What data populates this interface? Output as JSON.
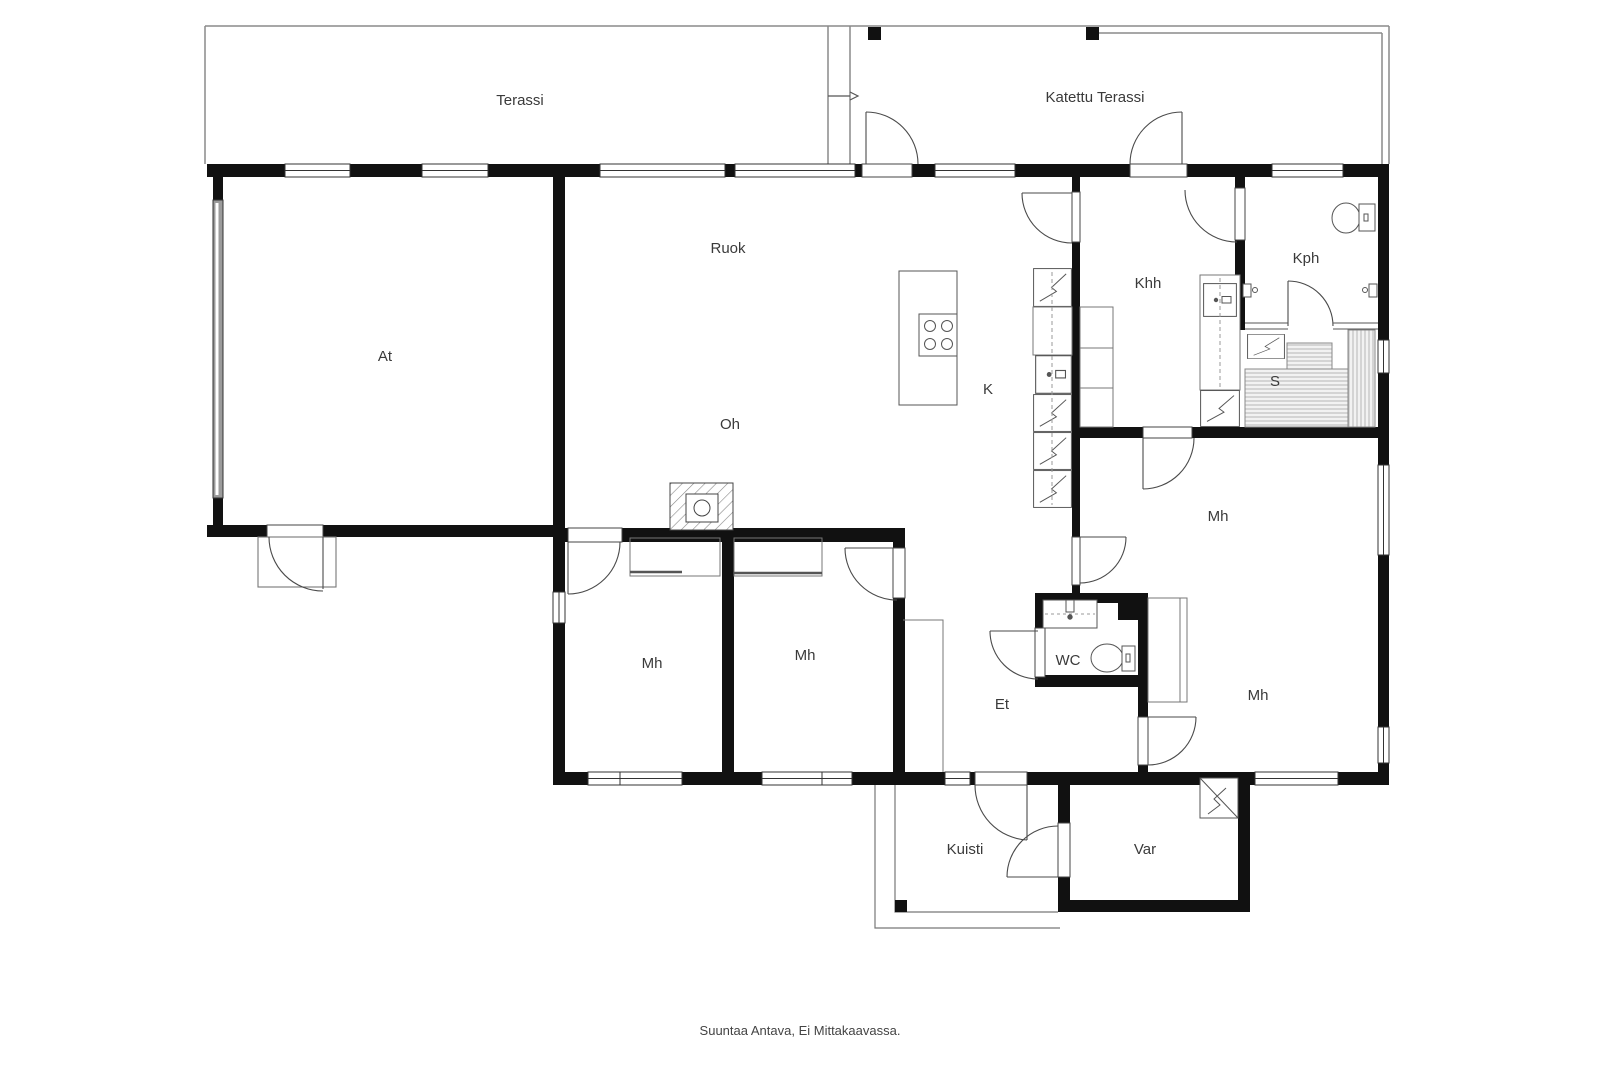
{
  "footer": {
    "note": "Suuntaa Antava, Ei Mittakaavassa."
  },
  "rooms": {
    "terassi": {
      "label": "Terassi"
    },
    "katettu_terassi": {
      "label": "Katettu Terassi"
    },
    "at": {
      "label": "At"
    },
    "ruok": {
      "label": "Ruok"
    },
    "oh": {
      "label": "Oh"
    },
    "k": {
      "label": "K"
    },
    "khh": {
      "label": "Khh"
    },
    "kph": {
      "label": "Kph"
    },
    "s": {
      "label": "S"
    },
    "mh_right": {
      "label": "Mh"
    },
    "mh_left": {
      "label": "Mh"
    },
    "mh_center": {
      "label": "Mh"
    },
    "mh_bottom_right": {
      "label": "Mh"
    },
    "wc": {
      "label": "WC"
    },
    "et": {
      "label": "Et"
    },
    "kuisti": {
      "label": "Kuisti"
    },
    "var": {
      "label": "Var"
    }
  },
  "colors": {
    "wall": "#111111",
    "line": "#4a4a4a",
    "furniture": "#777777",
    "terrace_line": "#8a8a8a",
    "label": "#3a3a3a",
    "garage_door": "#9b9b9b"
  }
}
